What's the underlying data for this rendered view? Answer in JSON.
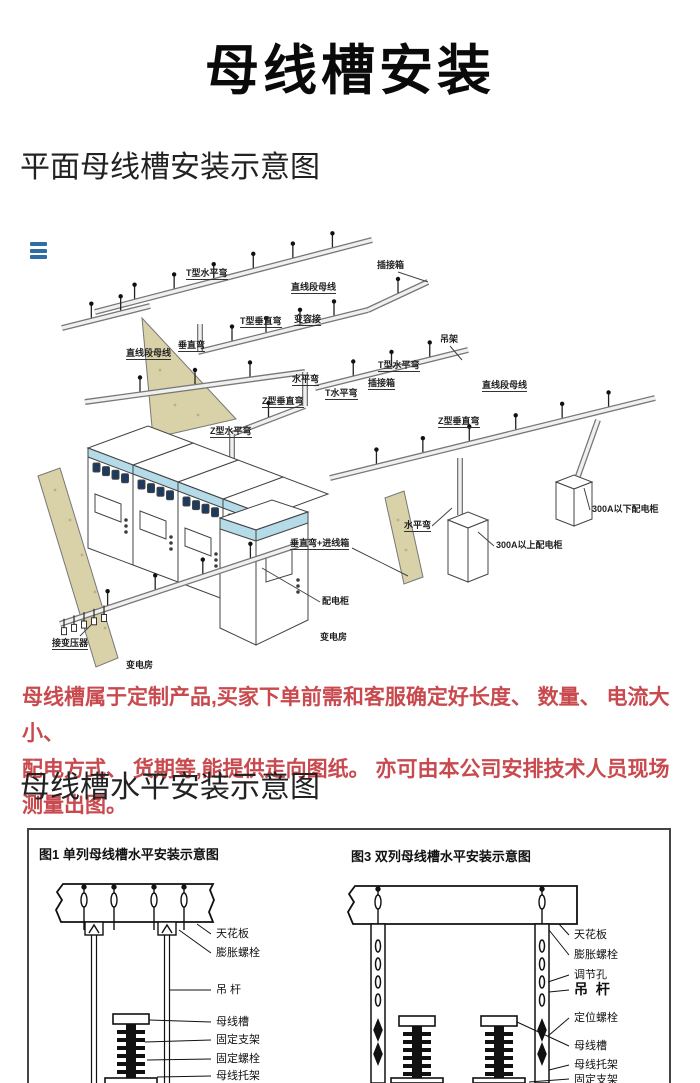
{
  "title": "母线槽安装",
  "sections": {
    "plane": "平面母线槽安装示意图",
    "horizontal": "母线槽水平安装示意图"
  },
  "note": {
    "line1": "母线槽属于定制产品,买家下单前需和客服确定好长度、 数量、 电流大小、",
    "line2": "配电方式、 货期等,能提供走向图纸。 亦可由本公司安排技术人员现场测量出图。",
    "color": "#c84a4e"
  },
  "colors": {
    "accent_blue": "#2f6ea5",
    "cabinet_cyan": "#b5dbe8",
    "wall_tan": "#d9d1a7",
    "line": "#444444",
    "note_red": "#c84a4e"
  },
  "icons": {
    "menu": "hamburger-menu-icon"
  },
  "diagram1": {
    "labels": [
      {
        "t": "T型水平弯",
        "x": 186,
        "y": 48,
        "u": 1
      },
      {
        "t": "直线段母线",
        "x": 291,
        "y": 62,
        "u": 1
      },
      {
        "t": "插接箱",
        "x": 377,
        "y": 40,
        "l": [
          398,
          52,
          428,
          62
        ]
      },
      {
        "t": "T型垂直弯",
        "x": 240,
        "y": 96,
        "u": 1
      },
      {
        "t": "变容接",
        "x": 294,
        "y": 94,
        "u": 1
      },
      {
        "t": "垂直弯",
        "x": 178,
        "y": 120,
        "u": 1
      },
      {
        "t": "直线段母线",
        "x": 126,
        "y": 128,
        "u": 1
      },
      {
        "t": "水平弯",
        "x": 292,
        "y": 154,
        "u": 1
      },
      {
        "t": "T水平弯",
        "x": 325,
        "y": 168,
        "u": 1
      },
      {
        "t": "Z型垂直弯",
        "x": 262,
        "y": 176,
        "u": 1
      },
      {
        "t": "Z型水平弯",
        "x": 210,
        "y": 206,
        "u": 1
      },
      {
        "t": "吊架",
        "x": 440,
        "y": 114,
        "l": [
          450,
          126,
          462,
          140
        ]
      },
      {
        "t": "T型水平弯",
        "x": 378,
        "y": 140,
        "u": 1
      },
      {
        "t": "插接箱",
        "x": 368,
        "y": 158,
        "u": 1
      },
      {
        "t": "直线段母线",
        "x": 482,
        "y": 160,
        "u": 1
      },
      {
        "t": "Z型垂直弯",
        "x": 438,
        "y": 196,
        "u": 1
      },
      {
        "t": "水平弯",
        "x": 404,
        "y": 300,
        "u": 1,
        "l": [
          432,
          306,
          452,
          288
        ]
      },
      {
        "t": "垂直弯+进线箱",
        "x": 290,
        "y": 318,
        "u": 1,
        "l": [
          352,
          328,
          408,
          356
        ]
      },
      {
        "t": "300A以上配电柜",
        "x": 496,
        "y": 320,
        "l": [
          494,
          326,
          478,
          312
        ]
      },
      {
        "t": "300A以下配电柜",
        "x": 592,
        "y": 284,
        "l": [
          590,
          290,
          584,
          268
        ]
      },
      {
        "t": "配电柜",
        "x": 322,
        "y": 376,
        "l": [
          320,
          382,
          262,
          348
        ]
      },
      {
        "t": "变电房",
        "x": 320,
        "y": 412
      },
      {
        "t": "接变压器",
        "x": 52,
        "y": 418,
        "u": 1,
        "l": [
          80,
          416,
          92,
          404
        ]
      },
      {
        "t": "变电房",
        "x": 126,
        "y": 440
      }
    ]
  },
  "diagram2": {
    "fig1_caption": "图1 单列母线槽水平安装示意图",
    "fig3_caption": "图3 双列母线槽水平安装示意图",
    "fig1_labels": [
      {
        "t": "天花板",
        "x": 187,
        "y": 98
      },
      {
        "t": "膨胀螺栓",
        "x": 187,
        "y": 117
      },
      {
        "t": "吊  杆",
        "x": 187,
        "y": 154
      },
      {
        "t": "母线槽",
        "x": 187,
        "y": 186
      },
      {
        "t": "固定支架",
        "x": 187,
        "y": 204
      },
      {
        "t": "固定螺栓",
        "x": 187,
        "y": 223
      },
      {
        "t": "母线托架",
        "x": 187,
        "y": 240
      }
    ],
    "fig3_labels": [
      {
        "t": "天花板",
        "x": 545,
        "y": 99
      },
      {
        "t": "膨胀螺栓",
        "x": 545,
        "y": 119
      },
      {
        "t": "调节孔",
        "x": 545,
        "y": 139
      },
      {
        "t": "吊 杆",
        "x": 545,
        "y": 153,
        "big": 1
      },
      {
        "t": "定位螺栓",
        "x": 545,
        "y": 182
      },
      {
        "t": "母线槽",
        "x": 545,
        "y": 210
      },
      {
        "t": "母线托架",
        "x": 545,
        "y": 229
      },
      {
        "t": "固定支架",
        "x": 545,
        "y": 244
      }
    ]
  }
}
